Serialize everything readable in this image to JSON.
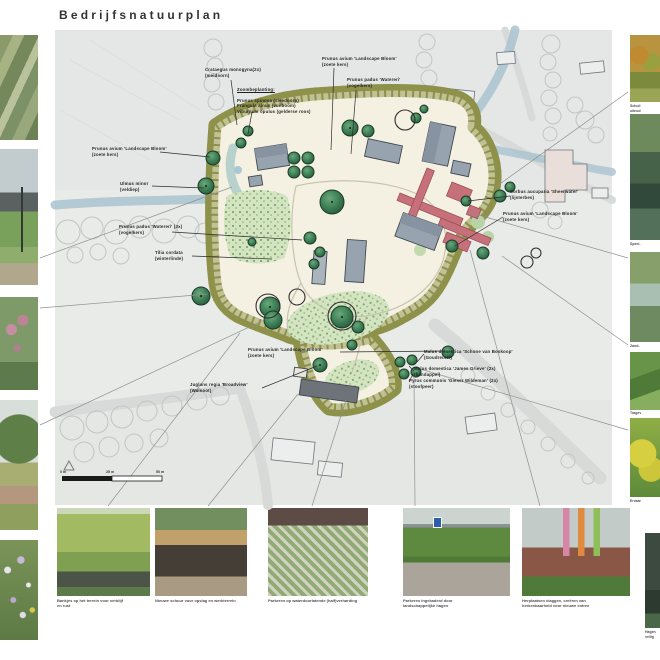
{
  "title": "Bedrijfsnatuurplan",
  "plan": {
    "annotations": [
      {
        "id": "crataegus",
        "text": "Crataegus monogyna(2x)\n(meidoorn)"
      },
      {
        "id": "zoom-title",
        "text": "Zoombeplanting:"
      },
      {
        "id": "zoom-body",
        "text": "Prunus spinosa (sleedoorn)\nFrangula alnus (vuilboom)\nViburnum opulus (gelderse roos)"
      },
      {
        "id": "prunus-avium-top",
        "text": "Prunus avium 'Landscape Bloom'\n(zoete kers)"
      },
      {
        "id": "prunus-padus-top",
        "text": "Prunus padus 'Watereri'\n(vogelkers)"
      },
      {
        "id": "prunus-avium-left",
        "text": "Prunus avium 'Landscape Bloom'\n(zoete kers)"
      },
      {
        "id": "ulmus-minor",
        "text": "Ulmus minor\n(veldiep)"
      },
      {
        "id": "prunus-padus-3x",
        "text": "Prunus padus 'Watereri' (3x)\n(vogelkers)"
      },
      {
        "id": "tilia-cordata",
        "text": "Tilia cordata\n(winterlinde)"
      },
      {
        "id": "sorbus",
        "text": "Sorbus aucuparia 'Sheerwater'\n(lijsterbes)"
      },
      {
        "id": "prunus-avium-right",
        "text": "Prunus avium 'Landscape Bloom'\n(zoete kers)"
      },
      {
        "id": "prunus-avium-bottom",
        "text": "Prunus avium 'Landscape Bloom'\n(zoete kers)"
      },
      {
        "id": "juglans",
        "text": "Juglans regia 'Broadview'\n(Walnoot)"
      },
      {
        "id": "malus-boskoop",
        "text": "Malus domestica 'Schone van Boskoop'\n(Goudreinet)"
      },
      {
        "id": "malus-james",
        "text": "Malus domestica 'James Grieve' (2x)\n(handappel)"
      },
      {
        "id": "pyrus",
        "text": "Pyrus communis 'Gieser Wildeman' (2x)\n(stoofpeer)"
      }
    ],
    "scale_labels": [
      "0 m",
      "25 m",
      "50 m"
    ]
  },
  "photos": {
    "bottom": [
      {
        "caption": "Bankjes op het terrein voor verblijf\nen rust"
      },
      {
        "caption": "Nieuwe schuur voor opslag en werkterrein"
      },
      {
        "caption": "Parkeren op waterdoorlatende (half)verharding"
      },
      {
        "caption": "Parkeren ingekaderd door\nlandschappelijke hagen"
      },
      {
        "caption": "Herplaatsen vlaggen, creëren van\nherkenbaarheid voor nieuwe entree"
      }
    ],
    "right": [
      {
        "caption": "Schuil\nuitnod"
      },
      {
        "caption": "Speel-"
      },
      {
        "caption": "Zand-"
      },
      {
        "caption": "Tragev"
      },
      {
        "caption": "Ervaar"
      },
      {
        "caption": "Hagen\nveilig"
      }
    ]
  },
  "colors": {
    "hedge": "#8e9149",
    "plan_ground": "#f4f1e3",
    "aerial_bg": "#e9ebe8",
    "tree_green": "#3c7d54",
    "accent_red": "#c5707a",
    "river_blue": "#a9c3cf"
  }
}
